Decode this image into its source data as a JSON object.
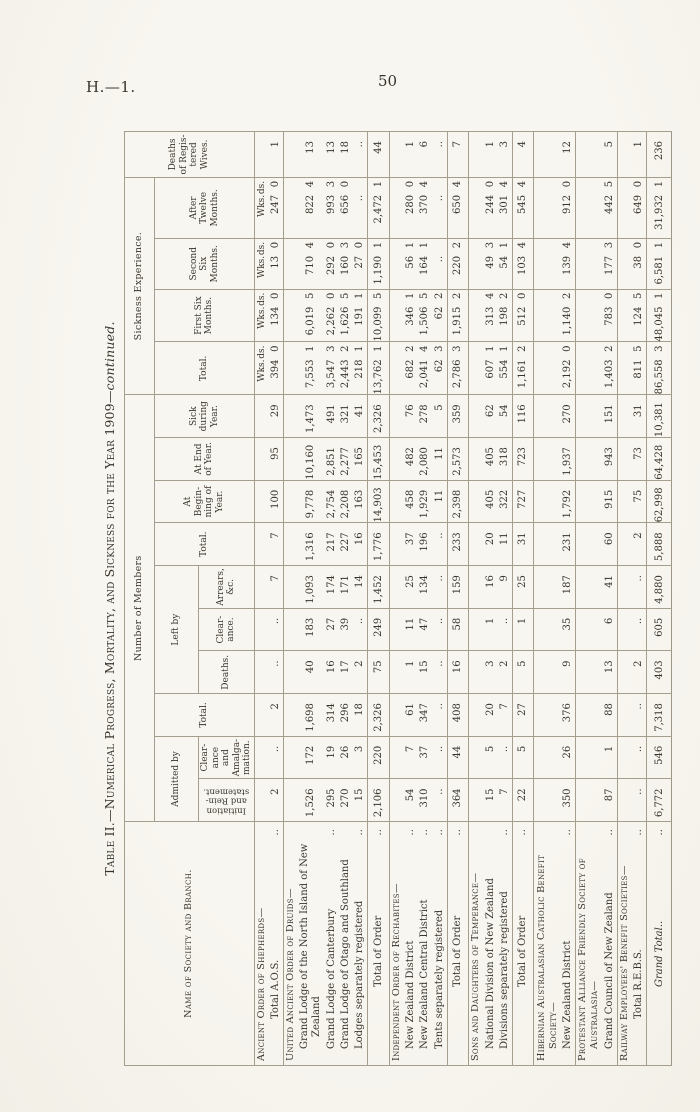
{
  "page": {
    "doc_ref": "H.—1.",
    "page_number": "50"
  },
  "table": {
    "title_main": "Table II.—Numerical Progress, Mortality, and Sickness for the Year 1909—",
    "title_continued": "continued.",
    "headers": {
      "name": "Name of Society and Branch.",
      "number_of_members": "Number of Members",
      "sickness_experience": "Sickness Experience.",
      "admitted_by": "Admitted by",
      "left_by": "Left by",
      "initiation": "Initiation and Rein- statement.",
      "clearance_amalg": "Clear- ance and Amalga- mation.",
      "total_admitted": "Total.",
      "deaths": "Deaths.",
      "clearance": "Clear- ance.",
      "arrears": "Arrears, &c.",
      "total_left": "Total.",
      "at_beginning": "At Begin- ning of Year.",
      "at_end": "At End of Year.",
      "sick_during_year": "Sick during Year.",
      "sick_total": "Total.",
      "first_six": "First Six Months.",
      "second_six": "Second Six Months.",
      "after_twelve": "After Twelve Months.",
      "deaths_wives": "Deaths of Regis- tered Wives.",
      "wks": "Wks.",
      "ds": "ds."
    },
    "rows": [
      {
        "type": "heading",
        "units": true,
        "lines": [
          {
            "t": "Ancient Order of Shepherds—",
            "i": 0
          }
        ]
      },
      {
        "type": "data",
        "lines": [
          {
            "t": "Total A.O.S.",
            "i": 3,
            "d": true
          }
        ],
        "cells": [
          "2",
          "..",
          "2",
          "..",
          "..",
          "7",
          "7",
          "100",
          "95",
          "29",
          [
            "394",
            "0"
          ],
          [
            "134",
            "0"
          ],
          [
            "13",
            "0"
          ],
          [
            "247",
            "0"
          ],
          "1"
        ]
      },
      {
        "type": "heading",
        "lines": [
          {
            "t": "United Ancient Order of Druids—",
            "i": 0
          }
        ]
      },
      {
        "type": "data",
        "lines": [
          {
            "t": "Grand Lodge of the North Island of New",
            "i": 1
          },
          {
            "t": "Zealand",
            "i": 2
          }
        ],
        "cells": [
          "1,526",
          "172",
          "1,698",
          "40",
          "183",
          "1,093",
          "1,316",
          "9,778",
          "10,160",
          "1,473",
          [
            "7,553",
            "1"
          ],
          [
            "6,019",
            "5"
          ],
          [
            "710",
            "4"
          ],
          [
            "822",
            "4"
          ],
          "13"
        ]
      },
      {
        "type": "data",
        "lines": [
          {
            "t": "Grand Lodge of Canterbury",
            "i": 1,
            "d": true
          }
        ],
        "cells": [
          "295",
          "19",
          "314",
          "16",
          "27",
          "174",
          "217",
          "2,754",
          "2,851",
          "491",
          [
            "3,547",
            "3"
          ],
          [
            "2,262",
            "0"
          ],
          [
            "292",
            "0"
          ],
          [
            "993",
            "3"
          ],
          "13"
        ]
      },
      {
        "type": "data",
        "lines": [
          {
            "t": "Grand Lodge of Otago and Southland",
            "i": 1
          }
        ],
        "cells": [
          "270",
          "26",
          "296",
          "17",
          "39",
          "171",
          "227",
          "2,208",
          "2,277",
          "321",
          [
            "2,443",
            "2"
          ],
          [
            "1,626",
            "5"
          ],
          [
            "160",
            "3"
          ],
          [
            "656",
            "0"
          ],
          "18"
        ]
      },
      {
        "type": "data",
        "lines": [
          {
            "t": "Lodges separately registered",
            "i": 1,
            "d": true
          }
        ],
        "cells": [
          "15",
          "3",
          "18",
          "2",
          "..",
          "14",
          "16",
          "163",
          "165",
          "41",
          [
            "218",
            "1"
          ],
          [
            "191",
            "1"
          ],
          [
            "27",
            "0"
          ],
          [
            "..",
            ""
          ],
          ".."
        ]
      },
      {
        "type": "total",
        "lines": [
          {
            "t": "Total of Order",
            "i": 6,
            "d": true
          }
        ],
        "cells": [
          "2,106",
          "220",
          "2,326",
          "75",
          "249",
          "1,452",
          "1,776",
          "14,903",
          "15,453",
          "2,326",
          [
            "13,762",
            "1"
          ],
          [
            "10,099",
            "5"
          ],
          [
            "1,190",
            "1"
          ],
          [
            "2,472",
            "1"
          ],
          "44"
        ]
      },
      {
        "type": "heading",
        "lines": [
          {
            "t": "Independent Order of Rechabites—",
            "i": 0
          }
        ]
      },
      {
        "type": "data",
        "lines": [
          {
            "t": "New Zealand District",
            "i": 1,
            "d": true
          }
        ],
        "cells": [
          "54",
          "7",
          "61",
          "1",
          "11",
          "25",
          "37",
          "458",
          "482",
          "76",
          [
            "682",
            "2"
          ],
          [
            "346",
            "1"
          ],
          [
            "56",
            "1"
          ],
          [
            "280",
            "0"
          ],
          "1"
        ]
      },
      {
        "type": "data",
        "lines": [
          {
            "t": "New Zealand Central District",
            "i": 1,
            "d": true
          }
        ],
        "cells": [
          "310",
          "37",
          "347",
          "15",
          "47",
          "134",
          "196",
          "1,929",
          "2,080",
          "278",
          [
            "2,041",
            "4"
          ],
          [
            "1,506",
            "5"
          ],
          [
            "164",
            "1"
          ],
          [
            "370",
            "4"
          ],
          "6"
        ]
      },
      {
        "type": "data",
        "lines": [
          {
            "t": "Tents separately registered",
            "i": 1,
            "d": true
          }
        ],
        "cells": [
          "..",
          "..",
          "..",
          "..",
          "..",
          "..",
          "..",
          "11",
          "11",
          "5",
          [
            "62",
            "3"
          ],
          [
            "62",
            "2"
          ],
          [
            "..",
            ""
          ],
          [
            "..",
            ""
          ],
          ".."
        ]
      },
      {
        "type": "total",
        "lines": [
          {
            "t": "Total of Order",
            "i": 6,
            "d": true
          }
        ],
        "cells": [
          "364",
          "44",
          "408",
          "16",
          "58",
          "159",
          "233",
          "2,398",
          "2,573",
          "359",
          [
            "2,786",
            "3"
          ],
          [
            "1,915",
            "2"
          ],
          [
            "220",
            "2"
          ],
          [
            "650",
            "4"
          ],
          "7"
        ]
      },
      {
        "type": "heading",
        "lines": [
          {
            "t": "Sons and Daughters of Temperance—",
            "i": 0
          }
        ]
      },
      {
        "type": "data",
        "lines": [
          {
            "t": "National Division of New Zealand",
            "i": 1
          }
        ],
        "cells": [
          "15",
          "5",
          "20",
          "3",
          "1",
          "16",
          "20",
          "405",
          "405",
          "62",
          [
            "607",
            "1"
          ],
          [
            "313",
            "4"
          ],
          [
            "49",
            "3"
          ],
          [
            "244",
            "0"
          ],
          "1"
        ]
      },
      {
        "type": "data",
        "lines": [
          {
            "t": "Divisions separately registered",
            "i": 1,
            "d": true
          }
        ],
        "cells": [
          "7",
          "..",
          "7",
          "2",
          "..",
          "9",
          "11",
          "322",
          "318",
          "54",
          [
            "554",
            "1"
          ],
          [
            "198",
            "2"
          ],
          [
            "54",
            "1"
          ],
          [
            "301",
            "4"
          ],
          "3"
        ]
      },
      {
        "type": "total",
        "lines": [
          {
            "t": "Total of Order",
            "i": 6,
            "d": true
          }
        ],
        "cells": [
          "22",
          "5",
          "27",
          "5",
          "1",
          "25",
          "31",
          "727",
          "723",
          "116",
          [
            "1,161",
            "2"
          ],
          [
            "512",
            "0"
          ],
          [
            "103",
            "4"
          ],
          [
            "545",
            "4"
          ],
          "4"
        ]
      },
      {
        "type": "heading",
        "lines": [
          {
            "t": "Hibernian Australasian Catholic Benefit",
            "i": 0
          },
          {
            "t": "Society—",
            "i": 1
          }
        ]
      },
      {
        "type": "data",
        "lines": [
          {
            "t": "New Zealand District",
            "i": 1,
            "d": true
          }
        ],
        "cells": [
          "350",
          "26",
          "376",
          "9",
          "35",
          "187",
          "231",
          "1,792",
          "1,937",
          "270",
          [
            "2,192",
            "0"
          ],
          [
            "1,140",
            "2"
          ],
          [
            "139",
            "4"
          ],
          [
            "912",
            "0"
          ],
          "12"
        ]
      },
      {
        "type": "heading",
        "lines": [
          {
            "t": "Protestant Alliance Friendly Society of",
            "i": 0
          },
          {
            "t": "Australasia—",
            "i": 1
          }
        ]
      },
      {
        "type": "data",
        "lines": [
          {
            "t": "Grand Council of New Zealand",
            "i": 1,
            "d": true
          }
        ],
        "cells": [
          "87",
          "1",
          "88",
          "13",
          "6",
          "41",
          "60",
          "915",
          "943",
          "151",
          [
            "1,403",
            "2"
          ],
          [
            "783",
            "0"
          ],
          [
            "177",
            "3"
          ],
          [
            "442",
            "5"
          ],
          "5"
        ]
      },
      {
        "type": "heading",
        "lines": [
          {
            "t": "Railway Employees' Benefit Societies—",
            "i": 0
          }
        ]
      },
      {
        "type": "data",
        "lines": [
          {
            "t": "Total R.E.B.S.",
            "i": 3,
            "d": true
          }
        ],
        "cells": [
          "..",
          "..",
          "..",
          "2",
          "..",
          "..",
          "2",
          "75",
          "73",
          "31",
          [
            "811",
            "5"
          ],
          [
            "124",
            "5"
          ],
          [
            "38",
            "0"
          ],
          [
            "649",
            "0"
          ],
          "1"
        ]
      },
      {
        "type": "grand",
        "lines": [
          {
            "t": "Grand Total..",
            "i": 6,
            "d": true
          }
        ],
        "cells": [
          "6,772",
          "546",
          "7,318",
          "403",
          "605",
          "4,880",
          "5,888",
          "62,998",
          "64,428",
          "10,381",
          [
            "86,558",
            "3"
          ],
          [
            "48,045",
            "1"
          ],
          [
            "6,581",
            "1"
          ],
          [
            "31,932",
            "1"
          ],
          "236"
        ]
      }
    ]
  }
}
